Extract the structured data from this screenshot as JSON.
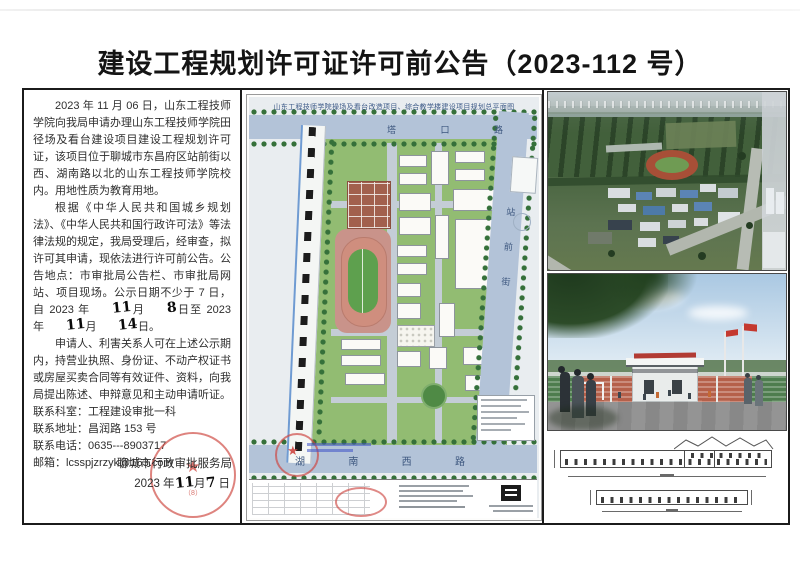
{
  "page_title": "建设工程规划许可证许可前公告（2023-112 号）",
  "notice": {
    "p1": "2023 年 11 月 06 日，山东工程技师学院向我局申请办理山东工程技师学院田径场及看台建设项目建设工程规划许可证，该项目位于聊城市东昌府区站前街以西、湖南路以北的山东工程技师学院校内。用地性质为教育用地。",
    "p2a": "根据《中华人民共和国城乡规划法》、《中华人民共和国行政许可法》等法律法规的规定，我局受理后，经审查，拟许可其申请，现依法进行许可前公告。公告地点：市审批局公告栏、市审批局网站、项目现场。公示日期不少于 7 日，自 2023 年",
    "hw_month1": "11",
    "p2b": "月",
    "hw_day1": "8",
    "p2c": "日至 2023 年",
    "hw_month2": "11",
    "p2d": "月",
    "hw_day2": "14",
    "p2e": "日。",
    "p3": "申请人、利害关系人可在上述公示期内，持营业执照、身份证、不动产权证书或房屋买卖合同等有效证件、资料，向我局提出陈述、申辩意见和主动申请听证。",
    "contact_dept": "联系科室：工程建设审批一科",
    "contact_addr": "联系地址：昌润路 153 号",
    "contact_tel": "联系电话：0635---8903717",
    "contact_email": "邮箱：lcsspjzrzyk@163.com"
  },
  "signature": {
    "org": "聊城市行政审批服务局",
    "date_year": "2023 年",
    "hw_month": "11",
    "date_month_suffix": "月",
    "hw_day": "7",
    "date_day_suffix": "日",
    "stamp_note": "（8）"
  },
  "site_plan": {
    "title": "山东工程技师学院操场及看台改造项目、综合教学楼建设项目规划总平面图",
    "road_top_c1": "塔",
    "road_top_c2": "口",
    "road_top_c3": "路",
    "road_right": "站前街",
    "road_bottom_c1": "湖",
    "road_bottom_c2": "南",
    "road_bottom_c3": "西",
    "road_bottom_c4": "路"
  },
  "colors": {
    "stamp_red": "#ce4a42",
    "road_blue": "#b3c3d8",
    "lawn_green": "#92bc72",
    "track_pink": "#cf8e7e",
    "field_green": "#5ea04e"
  }
}
